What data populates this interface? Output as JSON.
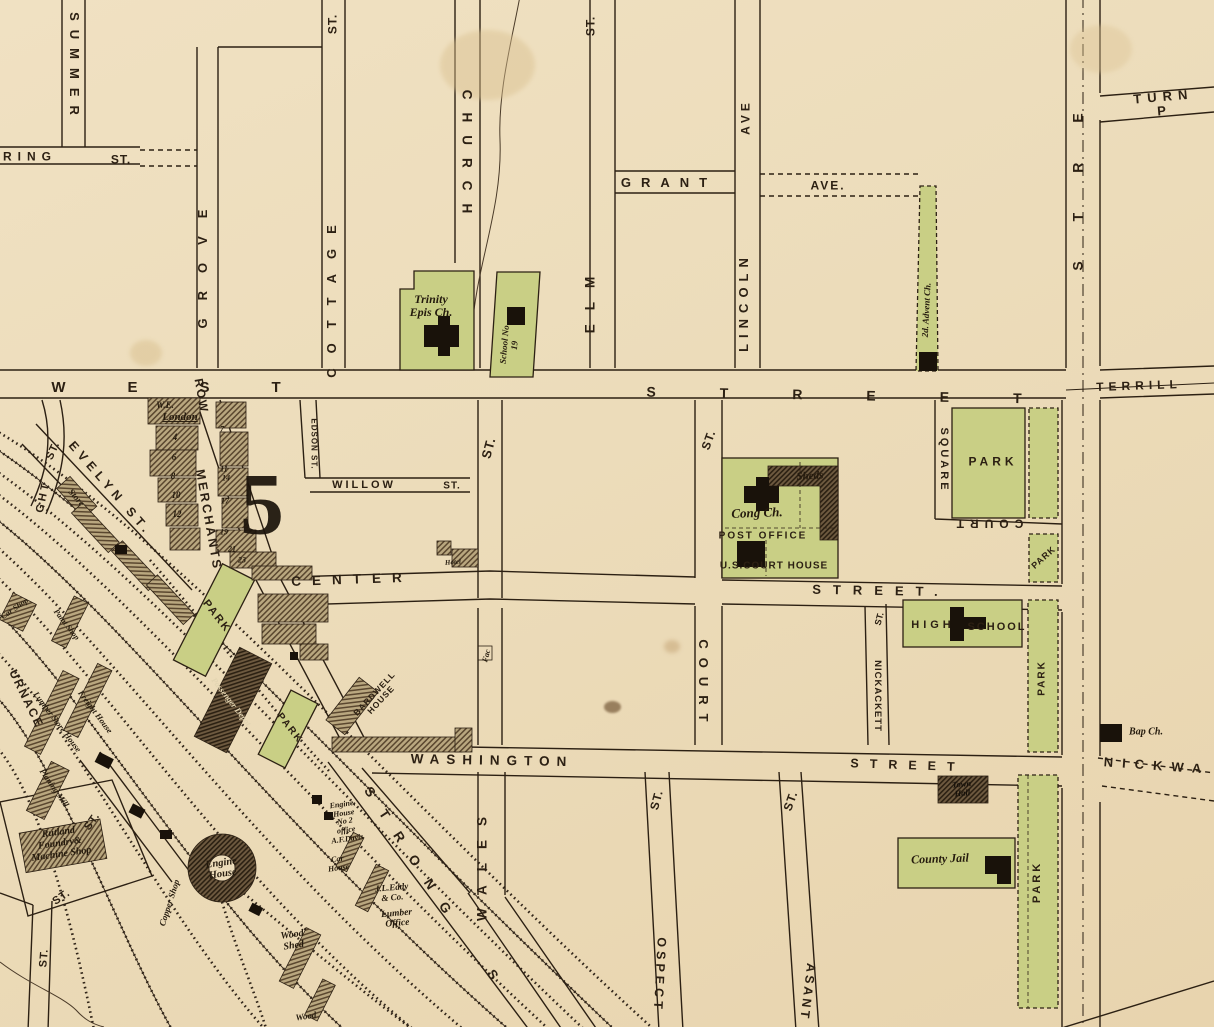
{
  "map": {
    "district_number": "5",
    "colors": {
      "paper": "#ecdcba",
      "ink": "#2c2013",
      "park_green": "#c9cf85",
      "building_black": "#19120a",
      "hatch_light": "#b9a77f",
      "hatch_dark": "#6e5a40",
      "creek": "#4a3a28"
    },
    "labels": [
      {
        "name": "ring-street",
        "text": "RING",
        "x": 30,
        "y": 157,
        "r": 0,
        "s": 12,
        "ls": 6,
        "cls": "caps"
      },
      {
        "name": "ring-street-st",
        "text": "ST.",
        "x": 121,
        "y": 160,
        "r": 0,
        "s": 12,
        "ls": 1,
        "cls": "caps"
      },
      {
        "name": "summer-street",
        "text": "SUMMER",
        "x": 74,
        "y": 68,
        "r": 90,
        "s": 13,
        "ls": 9,
        "cls": "caps"
      },
      {
        "name": "grove-street",
        "text": "GROVE",
        "x": 203,
        "y": 260,
        "r": -90,
        "s": 13,
        "ls": 18,
        "cls": "caps"
      },
      {
        "name": "cottage-street-st",
        "text": "ST.",
        "x": 333,
        "y": 24,
        "r": -90,
        "s": 12,
        "ls": 1,
        "cls": "caps"
      },
      {
        "name": "cottage-street",
        "text": "COTTAGE",
        "x": 332,
        "y": 294,
        "r": -90,
        "s": 13,
        "ls": 15,
        "cls": "caps"
      },
      {
        "name": "church-street",
        "text": "CHURCH",
        "x": 466,
        "y": 158,
        "r": 90,
        "s": 13.5,
        "ls": 13,
        "cls": "caps"
      },
      {
        "name": "elm-street-st",
        "text": "ST.",
        "x": 591,
        "y": 26,
        "r": -90,
        "s": 12,
        "ls": 1,
        "cls": "caps"
      },
      {
        "name": "elm-street",
        "text": "ELM",
        "x": 591,
        "y": 298,
        "r": -90,
        "s": 13.5,
        "ls": 14,
        "cls": "caps"
      },
      {
        "name": "grant-ave",
        "text": "GRANT",
        "x": 669,
        "y": 183,
        "r": 0,
        "s": 13,
        "ls": 10,
        "cls": "caps"
      },
      {
        "name": "grant-ave-ave",
        "text": "AVE.",
        "x": 828,
        "y": 186,
        "r": 0,
        "s": 12,
        "ls": 2,
        "cls": "caps"
      },
      {
        "name": "lincoln-ave",
        "text": "LINCOLN",
        "x": 744,
        "y": 302,
        "r": -90,
        "s": 13,
        "ls": 6,
        "cls": "caps"
      },
      {
        "name": "lincoln-ave-ave",
        "text": "AVE",
        "x": 746,
        "y": 117,
        "r": -90,
        "s": 12,
        "ls": 4,
        "cls": "caps"
      },
      {
        "name": "main-street-partial",
        "text": "STRE",
        "x": 1078,
        "y": 172,
        "r": -90,
        "s": 14,
        "ls": 40,
        "cls": "caps"
      },
      {
        "name": "turnpike",
        "text": "TURN P",
        "x": 1164,
        "y": 104,
        "r": -5,
        "s": 13,
        "ls": 6,
        "cls": "caps"
      },
      {
        "name": "terrill-street",
        "text": "TERRILL",
        "x": 1139,
        "y": 386,
        "r": -2,
        "s": 12,
        "ls": 5,
        "cls": "caps"
      },
      {
        "name": "west-street-west",
        "text": "WEST",
        "x": 197,
        "y": 388,
        "r": 0,
        "s": 15,
        "ls": 62,
        "cls": "caps"
      },
      {
        "name": "west-street-street",
        "text": "STREET",
        "x": 866,
        "y": 396,
        "r": 1,
        "s": 14,
        "ls": 64,
        "cls": "caps"
      },
      {
        "name": "willow-street",
        "text": "WILLOW",
        "x": 364,
        "y": 486,
        "r": 0,
        "s": 11,
        "ls": 3,
        "cls": "caps"
      },
      {
        "name": "willow-street-st",
        "text": "ST.",
        "x": 452,
        "y": 487,
        "r": 0,
        "s": 10,
        "ls": 1,
        "cls": "caps"
      },
      {
        "name": "edson-street",
        "text": "EDSON ST.",
        "x": 313,
        "y": 444,
        "r": 90,
        "s": 8,
        "ls": 1,
        "cls": "caps"
      },
      {
        "name": "mid-street-st",
        "text": "ST.",
        "x": 489,
        "y": 448,
        "r": -75,
        "s": 13,
        "ls": 1,
        "cls": "caps"
      },
      {
        "name": "center-street",
        "text": "CENTER",
        "x": 352,
        "y": 580,
        "r": -2,
        "s": 13.5,
        "ls": 11,
        "cls": "caps"
      },
      {
        "name": "center-street-street",
        "text": "STREET.",
        "x": 881,
        "y": 591,
        "r": 1,
        "s": 13,
        "ls": 12,
        "cls": "caps"
      },
      {
        "name": "court-street",
        "text": "COURT",
        "x": 703,
        "y": 685,
        "r": 90,
        "s": 13,
        "ls": 9,
        "cls": "caps"
      },
      {
        "name": "court-street-st",
        "text": "ST.",
        "x": 709,
        "y": 440,
        "r": -70,
        "s": 12,
        "ls": 1,
        "cls": "caps"
      },
      {
        "name": "court-square",
        "text": "SQUARE",
        "x": 943,
        "y": 460,
        "r": 90,
        "s": 11,
        "ls": 3,
        "cls": "caps"
      },
      {
        "name": "court-street-flipped",
        "text": "COURT",
        "x": 987,
        "y": 523,
        "r": 180,
        "s": 12,
        "ls": 6,
        "cls": "caps"
      },
      {
        "name": "nickackett-street-st",
        "text": "ST.",
        "x": 880,
        "y": 619,
        "r": -75,
        "s": 9,
        "ls": 0,
        "cls": "caps"
      },
      {
        "name": "nickackett-street",
        "text": "NICKACKETT",
        "x": 877,
        "y": 696,
        "r": 90,
        "s": 9.5,
        "ls": 1,
        "cls": "caps"
      },
      {
        "name": "washington-street",
        "text": "WASHINGTON",
        "x": 492,
        "y": 761,
        "r": 1,
        "s": 13.5,
        "ls": 7,
        "cls": "caps"
      },
      {
        "name": "washington-street-street",
        "text": "STREET",
        "x": 908,
        "y": 766,
        "r": 2,
        "s": 12.5,
        "ls": 11,
        "cls": "caps"
      },
      {
        "name": "nickwa-street",
        "text": "NICKWA",
        "x": 1157,
        "y": 766,
        "r": 4,
        "s": 13,
        "ls": 9,
        "cls": "caps"
      },
      {
        "name": "strong-street",
        "text": "STRONG",
        "x": 412,
        "y": 858,
        "r": 57,
        "s": 13.5,
        "ls": 18,
        "cls": "caps"
      },
      {
        "name": "strong-street-s",
        "text": "S",
        "x": 492,
        "y": 975,
        "r": 57,
        "s": 13.5,
        "ls": 0,
        "cls": "caps"
      },
      {
        "name": "wales-street",
        "text": "WALES",
        "x": 483,
        "y": 862,
        "r": -90,
        "s": 13.5,
        "ls": 14,
        "cls": "caps"
      },
      {
        "name": "prospect-street-st",
        "text": "ST.",
        "x": 657,
        "y": 800,
        "r": -75,
        "s": 12,
        "ls": 1,
        "cls": "caps"
      },
      {
        "name": "prospect-street",
        "text": "OSPECT",
        "x": 659,
        "y": 975,
        "r": 93,
        "s": 12.5,
        "ls": 4,
        "cls": "caps"
      },
      {
        "name": "pleasant-street-st",
        "text": "ST.",
        "x": 791,
        "y": 801,
        "r": -70,
        "s": 12,
        "ls": 1,
        "cls": "caps"
      },
      {
        "name": "pleasant-street",
        "text": "ASANT",
        "x": 807,
        "y": 992,
        "r": 97,
        "s": 12.5,
        "ls": 3,
        "cls": "caps"
      },
      {
        "name": "evelyn-street",
        "text": "EVELYN ST.",
        "x": 110,
        "y": 489,
        "r": 49,
        "s": 12.5,
        "ls": 5,
        "cls": "caps"
      },
      {
        "name": "merchants-row-row",
        "text": "ROW",
        "x": 201,
        "y": 396,
        "r": 80,
        "s": 12,
        "ls": 2,
        "cls": "caps"
      },
      {
        "name": "merchants-row",
        "text": "MERCHANTS",
        "x": 208,
        "y": 520,
        "r": 80,
        "s": 12.5,
        "ls": 2.5,
        "cls": "caps"
      },
      {
        "name": "ght-street",
        "text": "GHT",
        "x": 44,
        "y": 497,
        "r": -78,
        "s": 11,
        "ls": 3,
        "cls": "caps"
      },
      {
        "name": "ght-street-st",
        "text": "ST.",
        "x": 54,
        "y": 451,
        "r": -65,
        "s": 11,
        "ls": 1,
        "cls": "caps"
      },
      {
        "name": "furnace-street",
        "text": "URNACE",
        "x": 26,
        "y": 699,
        "r": 64,
        "s": 12,
        "ls": 2,
        "cls": "caps"
      },
      {
        "name": "st-label-a",
        "text": "ST.",
        "x": 93,
        "y": 822,
        "r": -55,
        "s": 11,
        "ls": 1,
        "cls": "caps"
      },
      {
        "name": "st-label-b",
        "text": "ST.",
        "x": 62,
        "y": 898,
        "r": -35,
        "s": 11,
        "ls": 1,
        "cls": "caps"
      },
      {
        "name": "st-label-c",
        "text": "ST.",
        "x": 45,
        "y": 958,
        "r": -85,
        "s": 11,
        "ls": 1,
        "cls": "caps"
      },
      {
        "name": "park-court-square",
        "text": "PARK",
        "x": 993,
        "y": 462,
        "r": 0,
        "s": 12,
        "ls": 4,
        "cls": "caps"
      },
      {
        "name": "park-small",
        "text": "PARK",
        "x": 1044,
        "y": 558,
        "r": -42,
        "s": 9,
        "ls": 1,
        "cls": "caps"
      },
      {
        "name": "park-strip-center",
        "text": "PARK",
        "x": 1043,
        "y": 678,
        "r": -90,
        "s": 10,
        "ls": 2,
        "cls": "caps"
      },
      {
        "name": "park-strip-south",
        "text": "PARK",
        "x": 1038,
        "y": 882,
        "r": -90,
        "s": 11,
        "ls": 3,
        "cls": "caps"
      },
      {
        "name": "park-depot-north",
        "text": "PARK",
        "x": 216,
        "y": 617,
        "r": 52,
        "s": 11,
        "ls": 2,
        "cls": "caps"
      },
      {
        "name": "park-depot-south",
        "text": "PARK",
        "x": 289,
        "y": 729,
        "r": 52,
        "s": 10,
        "ls": 2,
        "cls": "caps"
      },
      {
        "name": "district-number",
        "text": "5",
        "x": 262,
        "y": 505,
        "r": 0,
        "s": 88,
        "ls": 0,
        "cls": "big5"
      },
      {
        "name": "we-initials",
        "text": "W.E.",
        "x": 165,
        "y": 406,
        "r": 0,
        "s": 9,
        "ls": 0,
        "cls": "ital"
      },
      {
        "name": "london-label",
        "text": "London",
        "x": 180,
        "y": 418,
        "r": 0,
        "s": 11,
        "ls": 0,
        "cls": "ital und"
      },
      {
        "name": "trinity-epis-church",
        "text": "Trinity\nEpis Ch.",
        "x": 431,
        "y": 306,
        "r": 0,
        "s": 12,
        "ls": 0,
        "cls": "ital"
      },
      {
        "name": "school-no-19",
        "text": "School No\n19",
        "x": 510,
        "y": 345,
        "r": -85,
        "s": 9,
        "ls": 0,
        "cls": "ital"
      },
      {
        "name": "second-advent-church",
        "text": "2d. Advent Ch.",
        "x": 927,
        "y": 310,
        "r": -87,
        "s": 9,
        "ls": 0,
        "cls": "ital"
      },
      {
        "name": "cong-church",
        "text": "Cong Ch.",
        "x": 757,
        "y": 513,
        "r": -2,
        "s": 13,
        "ls": 0,
        "cls": "ital"
      },
      {
        "name": "sheds-label",
        "text": "Sheds",
        "x": 810,
        "y": 477,
        "r": -3,
        "s": 11,
        "ls": 0,
        "cls": "ital"
      },
      {
        "name": "post-office",
        "text": "POST OFFICE",
        "x": 763,
        "y": 537,
        "r": 0,
        "s": 10,
        "ls": 2,
        "cls": "capsb"
      },
      {
        "name": "us-court-house",
        "text": "U.S.COURT HOUSE",
        "x": 774,
        "y": 567,
        "r": 0,
        "s": 10,
        "ls": 1,
        "cls": "capsb"
      },
      {
        "name": "high-school-high",
        "text": "HIGH",
        "x": 933,
        "y": 626,
        "r": 0,
        "s": 11,
        "ls": 4,
        "cls": "capsb"
      },
      {
        "name": "high-school-school",
        "text": "SCHOOL",
        "x": 997,
        "y": 628,
        "r": 0,
        "s": 11,
        "ls": 2,
        "cls": "capsb"
      },
      {
        "name": "town-hall",
        "text": "Town\nHall",
        "x": 962,
        "y": 789,
        "r": -5,
        "s": 8.5,
        "ls": 0,
        "cls": "blkl"
      },
      {
        "name": "county-jail",
        "text": "County Jail",
        "x": 940,
        "y": 859,
        "r": -2,
        "s": 12,
        "ls": 0,
        "cls": "ital"
      },
      {
        "name": "baptist-church",
        "text": "Bap Ch.",
        "x": 1146,
        "y": 733,
        "r": 0,
        "s": 10,
        "ls": 0,
        "cls": "ital"
      },
      {
        "name": "bardwell-house",
        "text": "BARDWELL\nHOUSE",
        "x": 378,
        "y": 697,
        "r": -47,
        "s": 8.5,
        "ls": 1,
        "cls": "capsb"
      },
      {
        "name": "fac-label",
        "text": "Fac",
        "x": 487,
        "y": 656,
        "r": -75,
        "s": 8,
        "ls": 0,
        "cls": "ital"
      },
      {
        "name": "hotel-label",
        "text": "Hotel",
        "x": 453,
        "y": 563,
        "r": -5,
        "s": 7,
        "ls": 0,
        "cls": "ital"
      },
      {
        "name": "engine-house-no2",
        "text": "Engine,\nHouse\nNo 2\noffice\nA.F.Davis",
        "x": 345,
        "y": 822,
        "r": -8,
        "s": 8,
        "ls": 0,
        "cls": "ital"
      },
      {
        "name": "car-house",
        "text": "Car\nHouse",
        "x": 338,
        "y": 864,
        "r": -8,
        "s": 8,
        "ls": 0,
        "cls": "ital"
      },
      {
        "name": "jl-eddy-co",
        "text": "J.L.Eddy\n& Co.",
        "x": 392,
        "y": 893,
        "r": -5,
        "s": 9,
        "ls": 0,
        "cls": "ital"
      },
      {
        "name": "lumber-office",
        "text": "Lumber\nOffice",
        "x": 397,
        "y": 919,
        "r": -5,
        "s": 9.5,
        "ls": 0,
        "cls": "ital"
      },
      {
        "name": "engine-house-round",
        "text": "Engine\nHouse",
        "x": 222,
        "y": 869,
        "r": -8,
        "s": 10.5,
        "ls": 0,
        "cls": "ital"
      },
      {
        "name": "copper-shop",
        "text": "Copper Shop",
        "x": 170,
        "y": 903,
        "r": -72,
        "s": 9,
        "ls": 0,
        "cls": "ital"
      },
      {
        "name": "wood-shed",
        "text": "Wood\nShed",
        "x": 293,
        "y": 941,
        "r": -8,
        "s": 10,
        "ls": 0,
        "cls": "ital"
      },
      {
        "name": "wood-shed-2",
        "text": "Wood",
        "x": 306,
        "y": 1017,
        "r": -8,
        "s": 9,
        "ls": 0,
        "cls": "ital"
      },
      {
        "name": "rutland-foundry",
        "text": "Rutland\nFoundry&\nMachine Shop",
        "x": 60,
        "y": 844,
        "r": -8,
        "s": 10,
        "ls": 0,
        "cls": "ital"
      },
      {
        "name": "car-shop",
        "text": "Car Shop",
        "x": 15,
        "y": 609,
        "r": -35,
        "s": 8,
        "ls": 0,
        "cls": "ital"
      },
      {
        "name": "paint-shop",
        "text": "Paint Shop",
        "x": 66,
        "y": 625,
        "r": 52,
        "s": 8,
        "ls": 0,
        "cls": "ital"
      },
      {
        "name": "lumber-store-house",
        "text": "Lumber Store House",
        "x": 57,
        "y": 722,
        "r": 53,
        "s": 8.5,
        "ls": 0,
        "cls": "ital"
      },
      {
        "name": "freight-house",
        "text": "Freight House",
        "x": 95,
        "y": 712,
        "r": 53,
        "s": 8.5,
        "ls": 0,
        "cls": "ital"
      },
      {
        "name": "planing-mill",
        "text": "Planing Mill",
        "x": 54,
        "y": 788,
        "r": 55,
        "s": 8.5,
        "ls": 0,
        "cls": "ital"
      },
      {
        "name": "passenger-depot",
        "text": "Passenger Depot",
        "x": 231,
        "y": 702,
        "r": 52,
        "s": 8.5,
        "ls": 0,
        "cls": "ital light"
      },
      {
        "name": "store-label",
        "text": "Store",
        "x": 76,
        "y": 498,
        "r": 48,
        "s": 9,
        "ls": 0,
        "cls": "ital"
      },
      {
        "name": "lot-4",
        "text": "4",
        "x": 175,
        "y": 438,
        "r": 0,
        "s": 9,
        "ls": 0,
        "cls": "ital"
      },
      {
        "name": "lot-6",
        "text": "6",
        "x": 174,
        "y": 458,
        "r": 0,
        "s": 9,
        "ls": 0,
        "cls": "ital"
      },
      {
        "name": "lot-8",
        "text": "8",
        "x": 173,
        "y": 477,
        "r": 0,
        "s": 9,
        "ls": 0,
        "cls": "ital"
      },
      {
        "name": "lot-10",
        "text": "10",
        "x": 176,
        "y": 496,
        "r": 0,
        "s": 9,
        "ls": 0,
        "cls": "ital"
      },
      {
        "name": "lot-12",
        "text": "12",
        "x": 177,
        "y": 515,
        "r": 0,
        "s": 9,
        "ls": 0,
        "cls": "ital"
      },
      {
        "name": "lot-7",
        "text": "7",
        "x": 222,
        "y": 430,
        "r": 0,
        "s": 8,
        "ls": 0,
        "cls": "ital"
      },
      {
        "name": "lot-11",
        "text": "11",
        "x": 224,
        "y": 470,
        "r": 0,
        "s": 8,
        "ls": 0,
        "cls": "ital"
      },
      {
        "name": "lot-14",
        "text": "14",
        "x": 226,
        "y": 479,
        "r": 0,
        "s": 8,
        "ls": 0,
        "cls": "ital"
      },
      {
        "name": "lot-17",
        "text": "17",
        "x": 225,
        "y": 502,
        "r": 0,
        "s": 8,
        "ls": 0,
        "cls": "ital"
      },
      {
        "name": "lot-19",
        "text": "19",
        "x": 224,
        "y": 533,
        "r": 0,
        "s": 8,
        "ls": 0,
        "cls": "ital"
      },
      {
        "name": "lot-21",
        "text": "21",
        "x": 232,
        "y": 550,
        "r": 0,
        "s": 8,
        "ls": 0,
        "cls": "ital"
      },
      {
        "name": "lot-23",
        "text": "23",
        "x": 242,
        "y": 561,
        "r": 0,
        "s": 8,
        "ls": 0,
        "cls": "ital"
      }
    ]
  }
}
